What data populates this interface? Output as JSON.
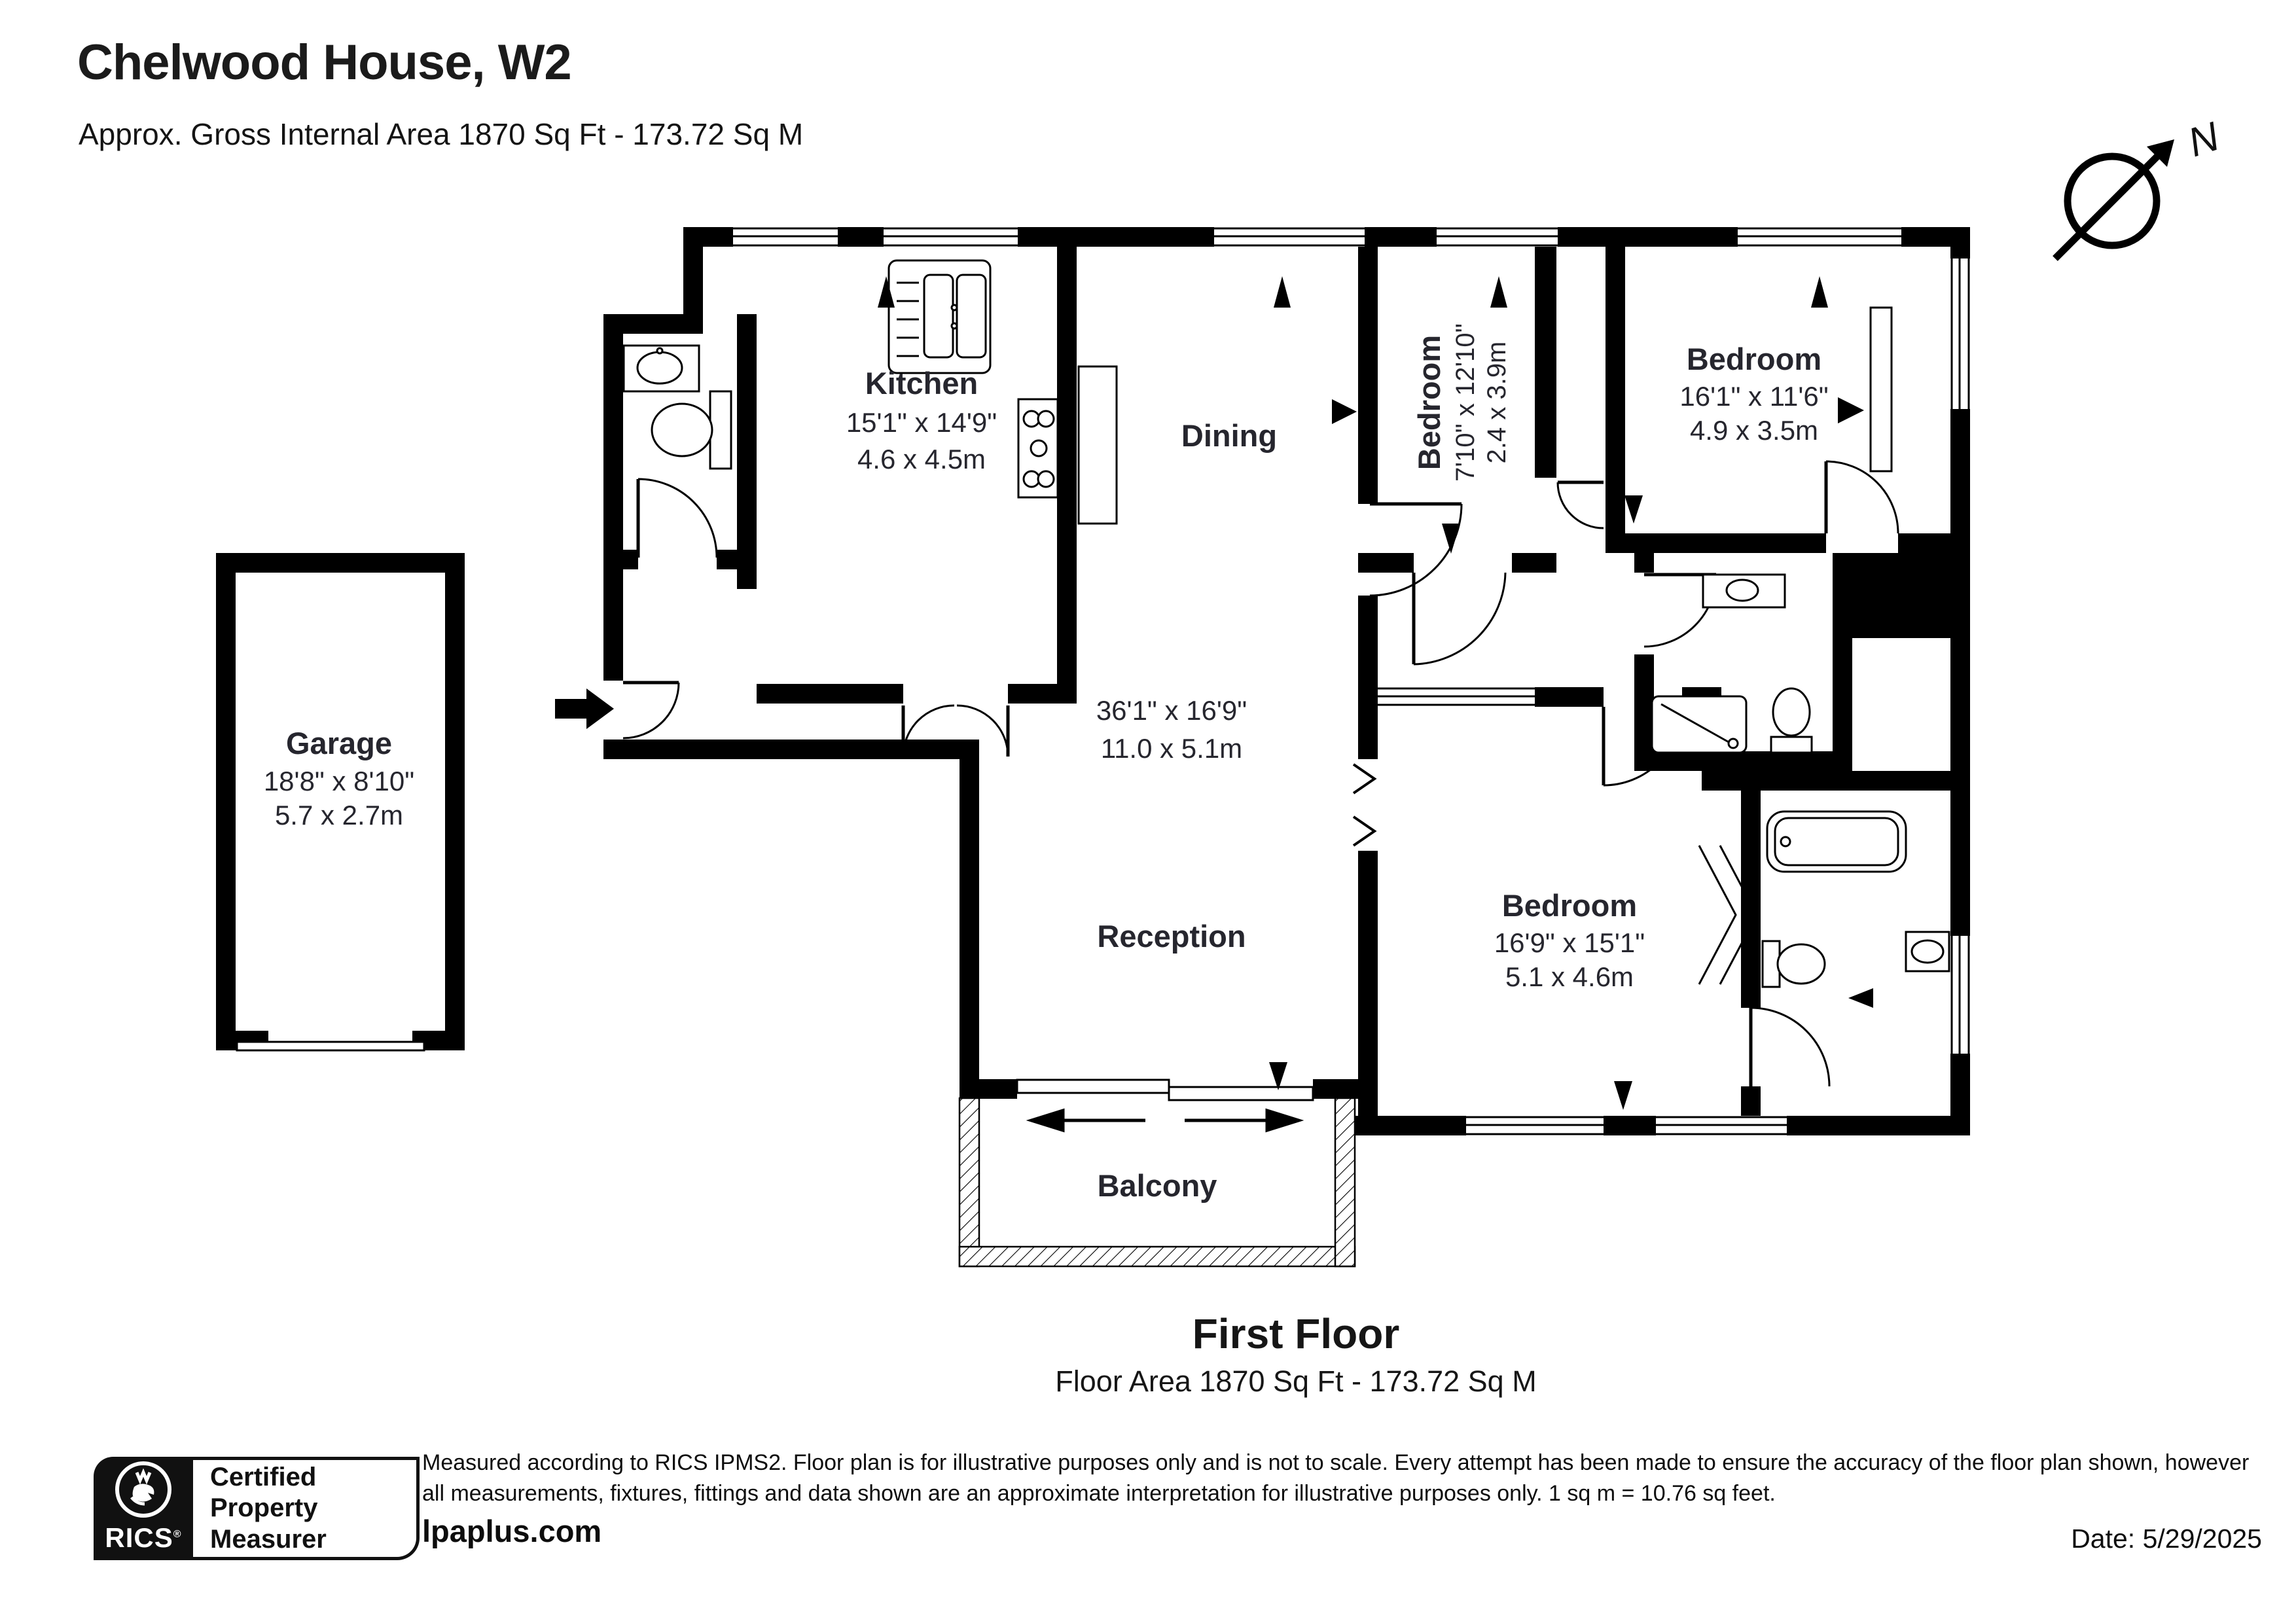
{
  "header": {
    "title": "Chelwood House, W2",
    "subtitle": "Approx. Gross Internal Area 1870 Sq Ft - 173.72 Sq M"
  },
  "compass": {
    "north_label": "N"
  },
  "rooms": {
    "kitchen": {
      "name": "Kitchen",
      "dims_imperial": "15'1\" x 14'9\"",
      "dims_metric": "4.6 x 4.5m"
    },
    "dining": {
      "name": "Dining"
    },
    "open_plan": {
      "dims_imperial": "36'1\" x 16'9\"",
      "dims_metric": "11.0 x 5.1m"
    },
    "reception": {
      "name": "Reception"
    },
    "bedroom_small": {
      "name": "Bedroom",
      "dims_imperial": "7'10\" x 12'10\"",
      "dims_metric": "2.4 x 3.9m"
    },
    "bedroom_top_right": {
      "name": "Bedroom",
      "dims_imperial": "16'1\" x 11'6\"",
      "dims_metric": "4.9 x 3.5m"
    },
    "bedroom_bottom": {
      "name": "Bedroom",
      "dims_imperial": "16'9\" x 15'1\"",
      "dims_metric": "5.1 x 4.6m"
    },
    "garage": {
      "name": "Garage",
      "dims_imperial": "18'8\" x 8'10\"",
      "dims_metric": "5.7 x 2.7m"
    },
    "balcony": {
      "name": "Balcony"
    }
  },
  "floor_label": {
    "title": "First Floor",
    "subtitle": "Floor Area 1870 Sq Ft - 173.72 Sq M"
  },
  "footer": {
    "badge": {
      "org": "RICS",
      "registered_mark": "®",
      "line1": "Certified",
      "line2": "Property",
      "line3": "Measurer"
    },
    "disclaimer": "Measured according to RICS IPMS2. Floor plan is for illustrative purposes only and is not to scale. Every attempt has been made to ensure the accuracy of the floor plan shown, however all measurements, fixtures, fittings and data shown are an approximate interpretation for illustrative purposes only. 1 sq m = 10.76 sq feet.",
    "website": "lpaplus.com",
    "date": "Date: 5/29/2025"
  },
  "colors": {
    "walls": "#000000",
    "text": "#26262e",
    "background": "#ffffff"
  }
}
